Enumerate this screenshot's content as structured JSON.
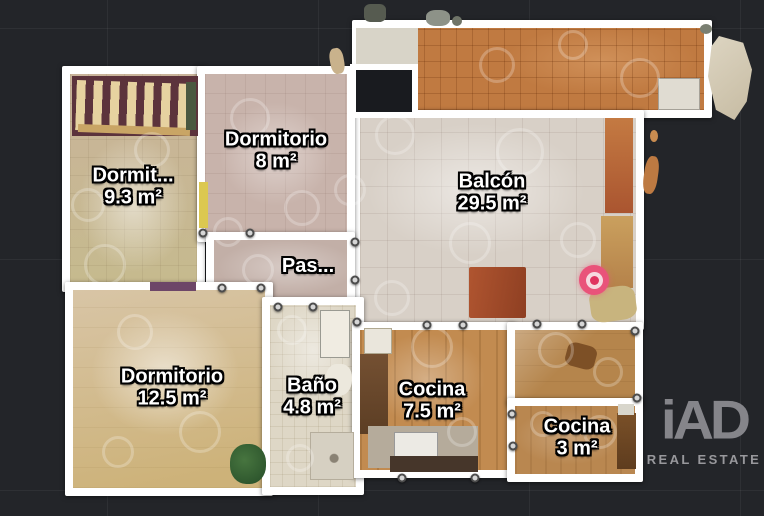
{
  "rooms": {
    "dormitorio_truncated": {
      "name": "Dormit...",
      "area": "9.3 m²"
    },
    "dormitorio_8": {
      "name": "Dormitorio",
      "area": "8 m²"
    },
    "balcon": {
      "name": "Balcón",
      "area": "29.5 m²"
    },
    "pasillo": {
      "name": "Pas..."
    },
    "dormitorio_12_5": {
      "name": "Dormitorio",
      "area": "12.5 m²"
    },
    "bano": {
      "name": "Baño",
      "area": "4.8 m²"
    },
    "cocina_7_5": {
      "name": "Cocina",
      "area": "7.5 m²"
    },
    "cocina_3": {
      "name": "Cocina",
      "area": "3 m²"
    }
  },
  "marker": {
    "type": "camera-position",
    "color": "#e9537a"
  },
  "branding": {
    "logo_text": "iAD",
    "tagline": "REAL ESTATE",
    "color": "#85858a"
  },
  "colors": {
    "background": "#232529",
    "wall": "#ffffff",
    "grid_line": "#34373c",
    "marker": "#e9537a"
  }
}
